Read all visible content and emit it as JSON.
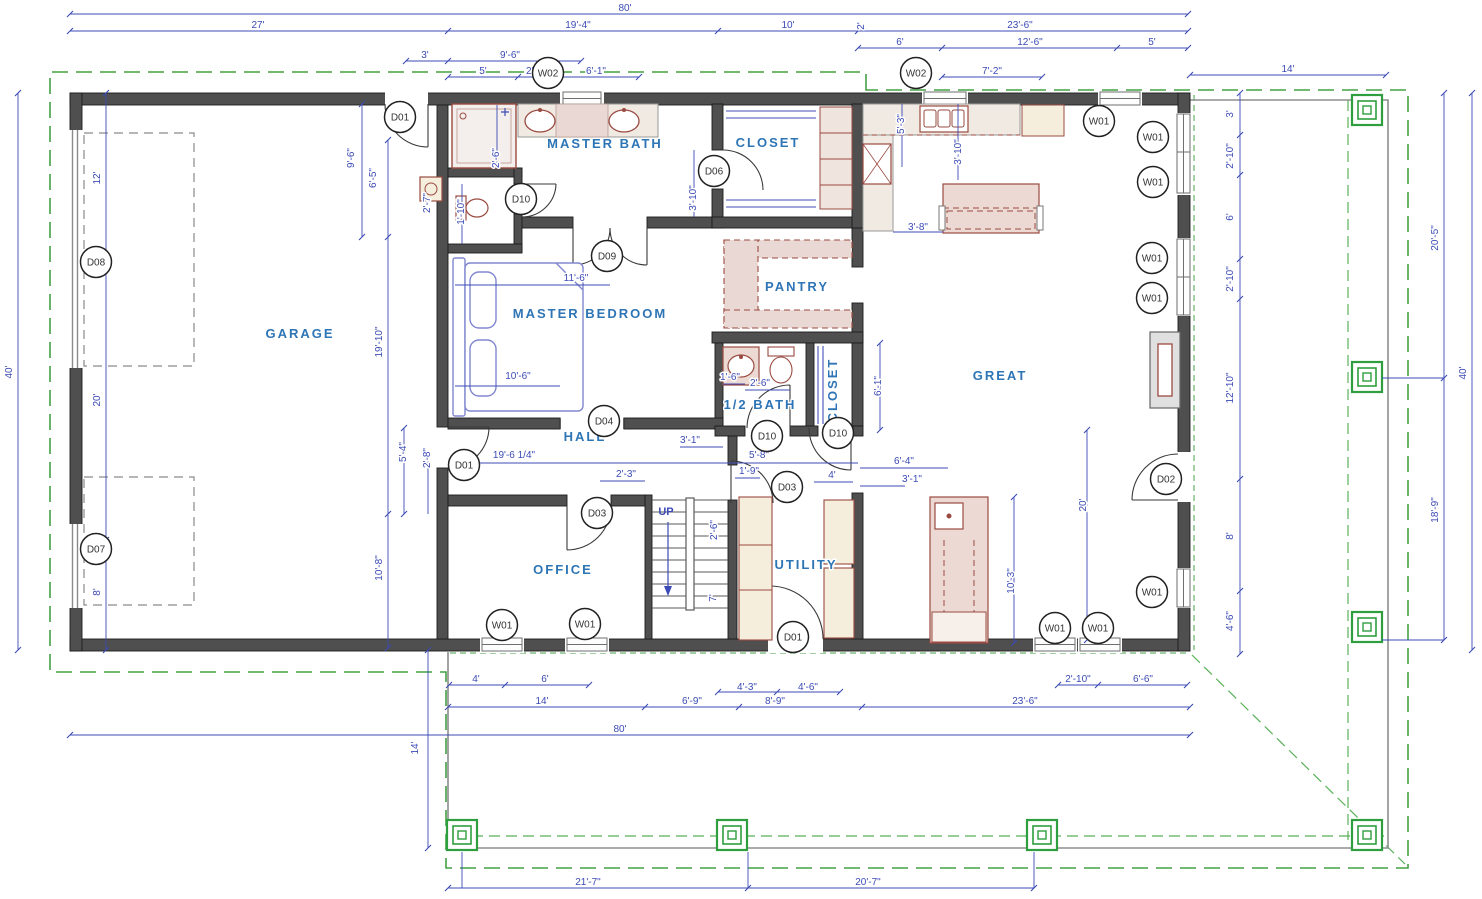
{
  "drawing": {
    "type": "residential-floor-plan",
    "footprint": "80' x 40'"
  },
  "colors": {
    "wall": "#4f4f4f",
    "dimension_blue": "#3c4bb5",
    "room_label_blue": "#2e75b6",
    "fixture_maroon": "#9a4a40",
    "cabinet_tan": "#f5eedd",
    "counter_pink": "#ecd9d4",
    "porch_green": "#3ba243",
    "furniture_blue": "#8087cf"
  },
  "rooms": [
    {
      "label": "GARAGE",
      "x": 300,
      "y": 338,
      "rot": 0
    },
    {
      "label": "MASTER BATH",
      "x": 605,
      "y": 148,
      "rot": 0
    },
    {
      "label": "CLOSET",
      "x": 768,
      "y": 147,
      "rot": 0
    },
    {
      "label": "MASTER BEDROOM",
      "x": 590,
      "y": 318,
      "rot": 0
    },
    {
      "label": "PANTRY",
      "x": 797,
      "y": 291,
      "rot": 0
    },
    {
      "label": "GREAT",
      "x": 1000,
      "y": 380,
      "rot": 0
    },
    {
      "label": "HALL",
      "x": 585,
      "y": 441,
      "rot": 0
    },
    {
      "label": "1/2 BATH",
      "x": 760,
      "y": 409,
      "rot": 0
    },
    {
      "label": "CLOSET",
      "x": 837,
      "y": 390,
      "rot": -90
    },
    {
      "label": "OFFICE",
      "x": 563,
      "y": 574,
      "rot": 0
    },
    {
      "label": "UTILITY",
      "x": 806,
      "y": 569,
      "rot": 0
    }
  ],
  "annotations": [
    {
      "text": "UP",
      "x": 666,
      "y": 515
    }
  ],
  "doors": [
    {
      "tag": "D01",
      "x": 400,
      "y": 117
    },
    {
      "tag": "D10",
      "x": 521,
      "y": 199
    },
    {
      "tag": "D06",
      "x": 714,
      "y": 171
    },
    {
      "tag": "D09",
      "x": 607,
      "y": 256
    },
    {
      "tag": "D04",
      "x": 604,
      "y": 421
    },
    {
      "tag": "D01",
      "x": 464,
      "y": 465
    },
    {
      "tag": "D10",
      "x": 767,
      "y": 436
    },
    {
      "tag": "D10",
      "x": 838,
      "y": 433
    },
    {
      "tag": "D03",
      "x": 787,
      "y": 487
    },
    {
      "tag": "D03",
      "x": 597,
      "y": 513
    },
    {
      "tag": "D01",
      "x": 793,
      "y": 637
    },
    {
      "tag": "D02",
      "x": 1166,
      "y": 479
    },
    {
      "tag": "D07",
      "x": 96,
      "y": 549
    },
    {
      "tag": "D08",
      "x": 96,
      "y": 262
    }
  ],
  "windows": [
    {
      "tag": "W02",
      "x": 548,
      "y": 73
    },
    {
      "tag": "W02",
      "x": 916,
      "y": 73
    },
    {
      "tag": "W01",
      "x": 1099,
      "y": 121
    },
    {
      "tag": "W01",
      "x": 1153,
      "y": 137
    },
    {
      "tag": "W01",
      "x": 1153,
      "y": 182
    },
    {
      "tag": "W01",
      "x": 1152,
      "y": 258
    },
    {
      "tag": "W01",
      "x": 1152,
      "y": 298
    },
    {
      "tag": "W01",
      "x": 1152,
      "y": 592
    },
    {
      "tag": "W01",
      "x": 502,
      "y": 625
    },
    {
      "tag": "W01",
      "x": 585,
      "y": 624
    },
    {
      "tag": "W01",
      "x": 1055,
      "y": 628
    },
    {
      "tag": "W01",
      "x": 1098,
      "y": 628
    }
  ],
  "dimensions": [
    {
      "text": "80'",
      "x": 625,
      "y": 11
    },
    {
      "text": "27'",
      "x": 258,
      "y": 28
    },
    {
      "text": "19'-4\"",
      "x": 578,
      "y": 28
    },
    {
      "text": "10'",
      "x": 788,
      "y": 28
    },
    {
      "text": "2'",
      "x": 864,
      "y": 26,
      "rot": -90
    },
    {
      "text": "23'-6\"",
      "x": 1020,
      "y": 28
    },
    {
      "text": "3'",
      "x": 425,
      "y": 58
    },
    {
      "text": "9'-6\"",
      "x": 510,
      "y": 58
    },
    {
      "text": "5'",
      "x": 483,
      "y": 74
    },
    {
      "text": "2'-7\"",
      "x": 536,
      "y": 74
    },
    {
      "text": "6'-1\"",
      "x": 596,
      "y": 74
    },
    {
      "text": "6'",
      "x": 900,
      "y": 45
    },
    {
      "text": "12'-6\"",
      "x": 1030,
      "y": 45
    },
    {
      "text": "5'",
      "x": 1152,
      "y": 45
    },
    {
      "text": "7'-2\"",
      "x": 992,
      "y": 74
    },
    {
      "text": "14'",
      "x": 1288,
      "y": 72
    },
    {
      "text": "40'",
      "x": 12,
      "y": 372,
      "rot": -90
    },
    {
      "text": "12'",
      "x": 100,
      "y": 178,
      "rot": -90
    },
    {
      "text": "20'",
      "x": 100,
      "y": 400,
      "rot": -90
    },
    {
      "text": "8'",
      "x": 100,
      "y": 592,
      "rot": -90
    },
    {
      "text": "9'-6\"",
      "x": 354,
      "y": 158,
      "rot": -90
    },
    {
      "text": "6'-5\"",
      "x": 376,
      "y": 178,
      "rot": -90
    },
    {
      "text": "2'-7\"",
      "x": 430,
      "y": 203,
      "rot": -90
    },
    {
      "text": "19'-10\"",
      "x": 382,
      "y": 342,
      "rot": -90
    },
    {
      "text": "5'-4\"",
      "x": 406,
      "y": 452,
      "rot": -90
    },
    {
      "text": "2'-8\"",
      "x": 430,
      "y": 458,
      "rot": -90
    },
    {
      "text": "10'-8\"",
      "x": 382,
      "y": 568,
      "rot": -90
    },
    {
      "text": "2'-6\"",
      "x": 499,
      "y": 158,
      "rot": -90
    },
    {
      "text": "1'-10\"",
      "x": 464,
      "y": 212,
      "rot": -90
    },
    {
      "text": "3'-10\"",
      "x": 696,
      "y": 198,
      "rot": -90
    },
    {
      "text": "5'-3\"",
      "x": 904,
      "y": 124,
      "rot": -90
    },
    {
      "text": "3'-10\"",
      "x": 961,
      "y": 152,
      "rot": -90
    },
    {
      "text": "3'-8\"",
      "x": 918,
      "y": 230
    },
    {
      "text": "11'-6\"",
      "x": 576,
      "y": 281
    },
    {
      "text": "10'-6\"",
      "x": 518,
      "y": 379
    },
    {
      "text": "19'-6 1/4\"",
      "x": 514,
      "y": 458
    },
    {
      "text": "2'-3\"",
      "x": 626,
      "y": 477
    },
    {
      "text": "3'-1\"",
      "x": 690,
      "y": 443
    },
    {
      "text": "5'-8\"",
      "x": 759,
      "y": 458
    },
    {
      "text": "1'-9\"",
      "x": 749,
      "y": 474
    },
    {
      "text": "4'",
      "x": 832,
      "y": 478
    },
    {
      "text": "1'-6\"",
      "x": 730,
      "y": 380
    },
    {
      "text": "2'-6\"",
      "x": 760,
      "y": 386
    },
    {
      "text": "6'-1\"",
      "x": 881,
      "y": 386,
      "rot": -90
    },
    {
      "text": "2'-6\"",
      "x": 717,
      "y": 530,
      "rot": -90
    },
    {
      "text": "7'",
      "x": 716,
      "y": 598,
      "rot": -90
    },
    {
      "text": "6'-4\"",
      "x": 904,
      "y": 464
    },
    {
      "text": "3'-1\"",
      "x": 912,
      "y": 482
    },
    {
      "text": "10'-3\"",
      "x": 1014,
      "y": 581,
      "rot": -90
    },
    {
      "text": "20'",
      "x": 1086,
      "y": 505,
      "rot": -90
    },
    {
      "text": "3'",
      "x": 1233,
      "y": 114,
      "rot": -90
    },
    {
      "text": "2'-10\"",
      "x": 1233,
      "y": 156,
      "rot": -90
    },
    {
      "text": "6'",
      "x": 1233,
      "y": 217,
      "rot": -90
    },
    {
      "text": "2'-10\"",
      "x": 1233,
      "y": 279,
      "rot": -90
    },
    {
      "text": "12'-10\"",
      "x": 1233,
      "y": 388,
      "rot": -90
    },
    {
      "text": "8'",
      "x": 1233,
      "y": 536,
      "rot": -90
    },
    {
      "text": "4'-6\"",
      "x": 1233,
      "y": 621,
      "rot": -90
    },
    {
      "text": "20'-5\"",
      "x": 1438,
      "y": 238,
      "rot": -90
    },
    {
      "text": "18'-9\"",
      "x": 1438,
      "y": 510,
      "rot": -90
    },
    {
      "text": "40'",
      "x": 1466,
      "y": 373,
      "rot": -90
    },
    {
      "text": "4'",
      "x": 476,
      "y": 682
    },
    {
      "text": "6'",
      "x": 545,
      "y": 682
    },
    {
      "text": "4'-3\"",
      "x": 747,
      "y": 690
    },
    {
      "text": "4'-6\"",
      "x": 808,
      "y": 690
    },
    {
      "text": "2'-10\"",
      "x": 1078,
      "y": 682
    },
    {
      "text": "6'-6\"",
      "x": 1143,
      "y": 682
    },
    {
      "text": "14'",
      "x": 542,
      "y": 704
    },
    {
      "text": "6'-9\"",
      "x": 692,
      "y": 704
    },
    {
      "text": "8'-9\"",
      "x": 775,
      "y": 704
    },
    {
      "text": "23'-6\"",
      "x": 1025,
      "y": 704
    },
    {
      "text": "80'",
      "x": 620,
      "y": 732
    },
    {
      "text": "14'",
      "x": 418,
      "y": 748,
      "rot": -90
    },
    {
      "text": "21'-7\"",
      "x": 588,
      "y": 885
    },
    {
      "text": "20'-7\"",
      "x": 868,
      "y": 885
    }
  ]
}
